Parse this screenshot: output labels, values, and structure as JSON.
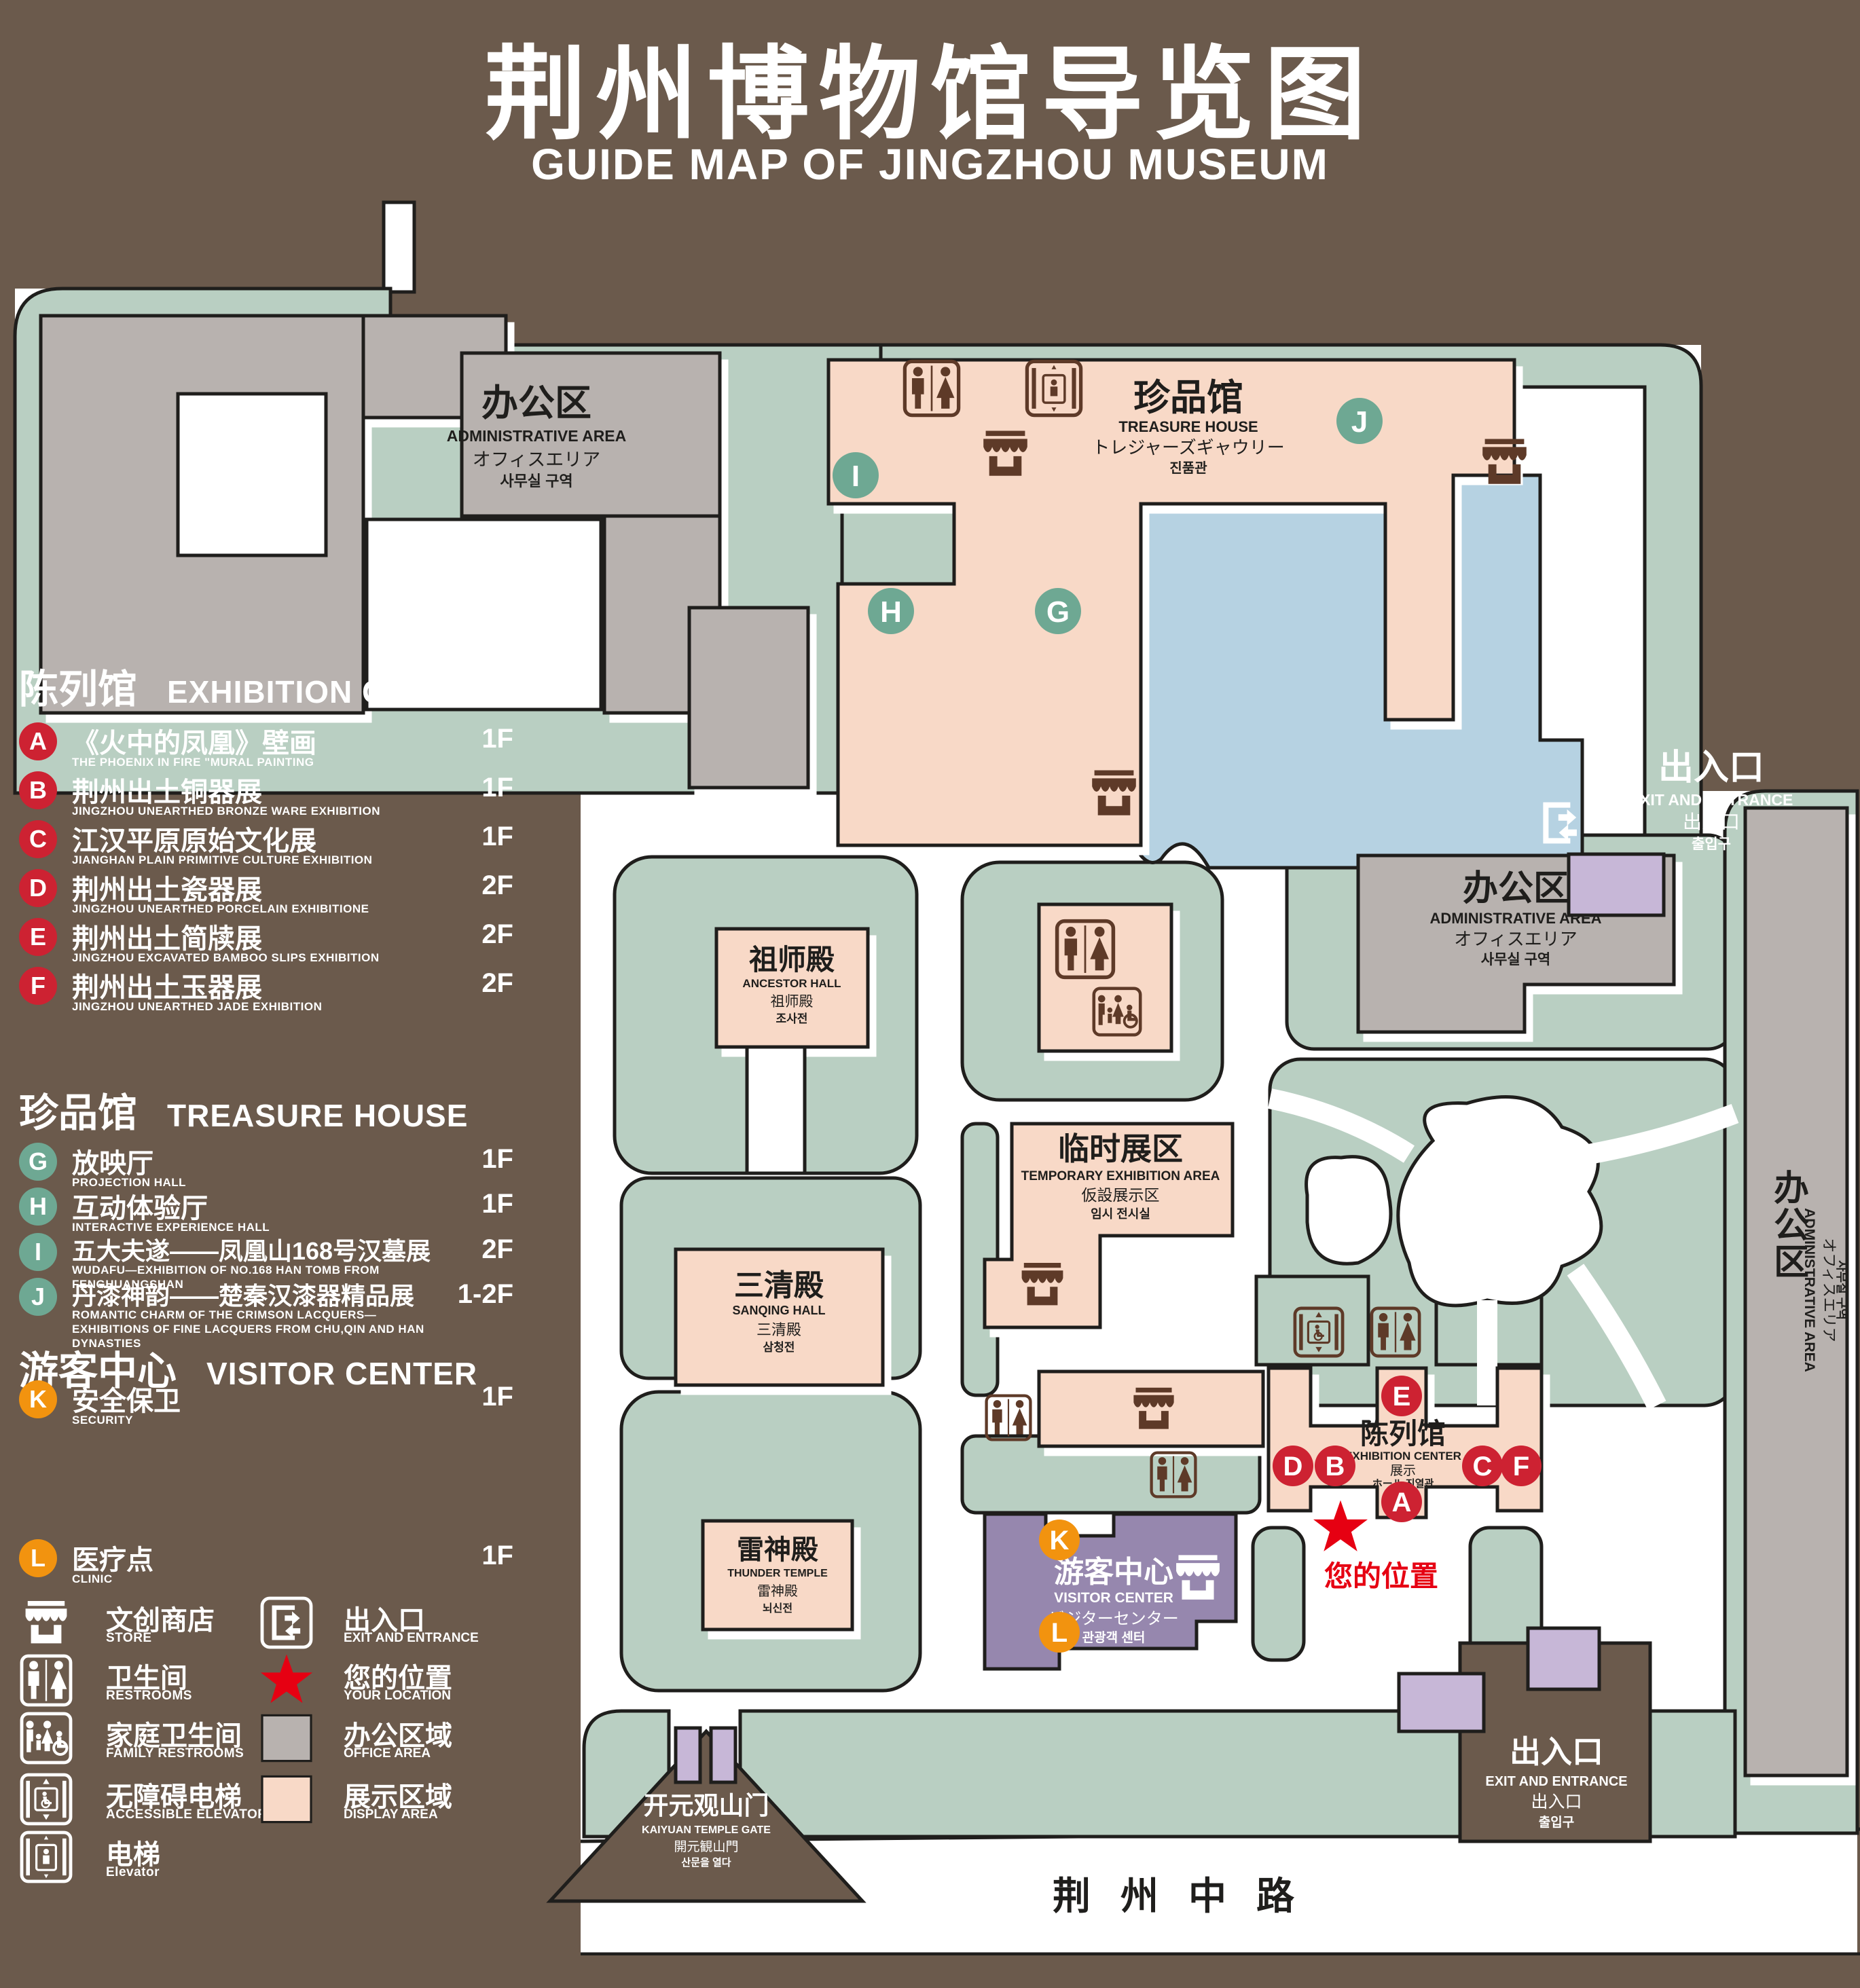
{
  "title": {
    "zh": "荆州博物馆导览图",
    "en": "GUIDE MAP OF JINGZHOU MUSEUM"
  },
  "legend": {
    "sections": [
      {
        "zh": "陈列馆",
        "en": "EXHIBITION CENTER",
        "items": [
          {
            "letter": "A",
            "zh": "《火中的凤凰》壁画",
            "en": "THE PHOENIX IN FIRE \"MURAL PAINTING",
            "floor": "1F"
          },
          {
            "letter": "B",
            "zh": "荆州出土铜器展",
            "en": "JINGZHOU UNEARTHED BRONZE WARE EXHIBITION",
            "floor": "1F"
          },
          {
            "letter": "C",
            "zh": "江汉平原原始文化展",
            "en": "JIANGHAN PLAIN PRIMITIVE CULTURE EXHIBITION",
            "floor": "1F"
          },
          {
            "letter": "D",
            "zh": "荆州出土瓷器展",
            "en": "JINGZHOU UNEARTHED PORCELAIN EXHIBITIONE",
            "floor": "2F"
          },
          {
            "letter": "E",
            "zh": "荆州出土简牍展",
            "en": "JINGZHOU EXCAVATED BAMBOO SLIPS EXHIBITION",
            "floor": "2F"
          },
          {
            "letter": "F",
            "zh": "荆州出土玉器展",
            "en": "JINGZHOU UNEARTHED JADE EXHIBITION",
            "floor": "2F"
          }
        ]
      },
      {
        "zh": "珍品馆",
        "en": "TREASURE HOUSE",
        "items": [
          {
            "letter": "G",
            "zh": "放映厅",
            "en": "PROJECTION HALL",
            "floor": "1F"
          },
          {
            "letter": "H",
            "zh": "互动体验厅",
            "en": "INTERACTIVE EXPERIENCE HALL",
            "floor": "1F"
          },
          {
            "letter": "I",
            "zh": "五大夫遂——凤凰山168号汉墓展",
            "en": "WUDAFU—EXHIBITION OF NO.168 HAN TOMB FROM FENGHUANGSHAN",
            "floor": "2F"
          },
          {
            "letter": "J",
            "zh": "丹漆神韵——楚秦汉漆器精品展",
            "en": "ROMANTIC CHARM OF THE CRIMSON LACQUERS—EXHIBITIONS OF FINE LACQUERS FROM CHU,QIN AND HAN DYNASTIES",
            "floor": "1-2F"
          }
        ]
      },
      {
        "zh": "游客中心",
        "en": "VISITOR CENTER",
        "items": [
          {
            "letter": "K",
            "zh": "安全保卫",
            "en": "SECURITY",
            "floor": "1F"
          },
          {
            "letter": "L",
            "zh": "医疗点",
            "en": "CLINIC",
            "floor": "1F"
          }
        ]
      }
    ],
    "pictograms": [
      {
        "icon": "store-icon",
        "zh": "文创商店",
        "en": "STORE"
      },
      {
        "icon": "restrooms-icon",
        "zh": "卫生间",
        "en": "RESTROOMS"
      },
      {
        "icon": "family-restrooms-icon",
        "zh": "家庭卫生间",
        "en": "FAMILY RESTROOMS"
      },
      {
        "icon": "accessible-elevator-icon",
        "zh": "无障碍电梯",
        "en": "ACCESSIBLE ELEVATOR"
      },
      {
        "icon": "elevator-icon",
        "zh": "电梯",
        "en": "Elevator"
      }
    ],
    "areas": [
      {
        "icon": "exit-entrance-icon",
        "zh": "出入口",
        "en": "EXIT AND ENTRANCE"
      },
      {
        "icon": "your-location-star",
        "zh": "您的位置",
        "en": "YOUR LOCATION"
      },
      {
        "icon": "office-area-swatch",
        "zh": "办公区域",
        "en": "OFFICE AREA"
      },
      {
        "icon": "display-area-swatch",
        "zh": "展示区域",
        "en": "DISPLAY AREA"
      }
    ]
  },
  "map": {
    "buildings": {
      "admin": {
        "zh": "办公区",
        "en": "ADMINISTRATIVE AREA",
        "ja": "オフィスエリア",
        "ko": "사무실 구역"
      },
      "treasure_house": {
        "zh": "珍品馆",
        "en": "TREASURE HOUSE",
        "ja": "トレジャーズギャウリー",
        "ko": "진품관"
      },
      "ancestor_hall": {
        "zh": "祖师殿",
        "en": "ANCESTOR HALL",
        "ja": "祖师殿",
        "ko": "조사전"
      },
      "sanqing_hall": {
        "zh": "三清殿",
        "en": "SANQING HALL",
        "ja": "三清殿",
        "ko": "삼청전"
      },
      "thunder_temple": {
        "zh": "雷神殿",
        "en": "THUNDER TEMPLE",
        "ja": "雷神殿",
        "ko": "뇌신전"
      },
      "temporary_area": {
        "zh": "临时展区",
        "en": "TEMPORARY EXHIBITION AREA",
        "ja": "仮設展示区",
        "ko": "임시 전시실"
      },
      "visitor_center": {
        "zh": "游客中心",
        "en": "VISITOR CENTER",
        "ja": "ビジターセンター",
        "ko": "관광객 센터"
      },
      "exhibition_center": {
        "zh": "陈列馆",
        "en": "EXHIBITION CENTER",
        "ja": "展示",
        "ko": "ホール 진열관"
      }
    },
    "gates": {
      "exit": {
        "zh": "出入口",
        "en": "EXIT AND ENTRANCE",
        "ja": "出入口",
        "ko": "출입구"
      },
      "south": {
        "zh": "开元观山门",
        "en": "KAIYUAN TEMPLE GATE",
        "ja": "開元観山門",
        "ko": "산문을 열다"
      }
    },
    "your_location": "您的位置",
    "road": "荆州中路"
  },
  "colors": {
    "background": "#6b5a4c",
    "grass": "#b9cfc2",
    "display_area": "#f8d9c7",
    "office_area": "#b8b2af",
    "pond": "#b6d2e2",
    "visitor_purple": "#9687ae",
    "gate_purple": "#c7b7d7",
    "marker_red": "#cd2232",
    "marker_green": "#6ea893",
    "marker_orange": "#f2930f",
    "icon_brown": "#5e3a28",
    "location_red": "#e60012"
  }
}
